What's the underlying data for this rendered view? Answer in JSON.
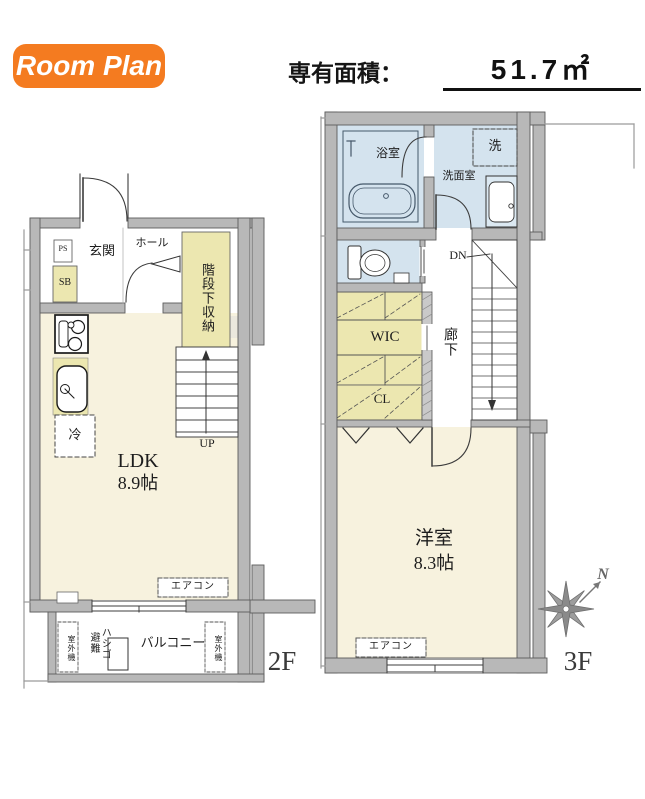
{
  "header": {
    "badge_label": "Room Plan",
    "area_label": "専有面積：",
    "area_value": "51.7㎡"
  },
  "plans": {
    "f2": {
      "floor_label": "2F",
      "ps": "PS",
      "sb": "SB",
      "genkan": "玄関",
      "hall": "ホール",
      "under_stair_storage": "階段下収納",
      "fridge": "冷",
      "ldk_name": "LDK",
      "ldk_size": "8.9帖",
      "up_label": "UP",
      "aircon_label": "エアコン",
      "escape_ladder_1": "避難",
      "escape_ladder_2": "ハシゴ",
      "balcony_label": "バルコニー",
      "outdoor_unit": "室外機"
    },
    "f3": {
      "floor_label": "3F",
      "bathroom": "浴室",
      "washer": "洗",
      "washroom": "洗面室",
      "dn_label": "DN",
      "wic": "WIC",
      "corridor": "廊下",
      "closet": "CL",
      "bedroom_name": "洋室",
      "bedroom_size": "8.3帖",
      "aircon_label": "エアコン",
      "north_label": "N"
    }
  },
  "colors": {
    "accent_orange": "#f47b20",
    "wall_gray": "#b8b8b8",
    "floor_cream": "#f7f2de",
    "wet_area_blue": "#d4e3ee",
    "storage_yellow": "#ece7b0",
    "line_dark": "#3c3c3c"
  }
}
